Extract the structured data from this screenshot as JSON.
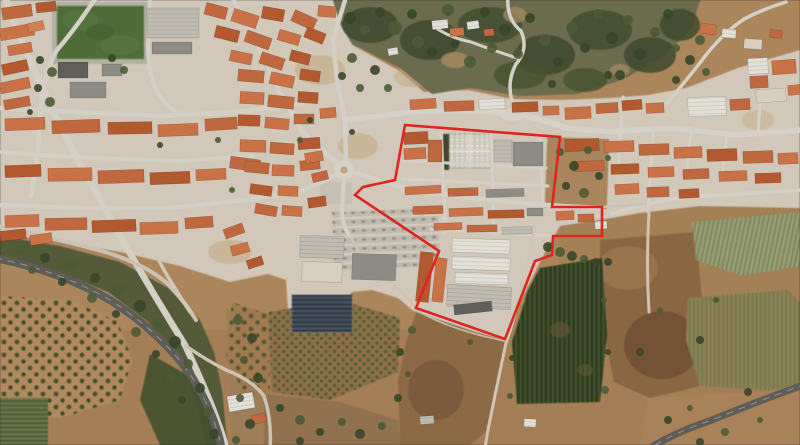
{
  "description": "Satellite aerial photograph of a town with terracotta rooftops, a wooded hillside, highways, farm fields and a red site-boundary polygon outlined over the central district.",
  "visible_text": [],
  "boundary": {
    "name": "red-boundary-polygon",
    "color": "#e02420",
    "stroke_width": 2.6,
    "points": "405,125 560,137 552,207 602,207 602,236 553,236 552,255 535,261 505,339 416,308 439,251 355,195 363,187 395,180"
  },
  "palette": {
    "terrain_base": "#ab865c",
    "town_ground": "#d1c8b9",
    "road": "#d5d0c6",
    "highway": "#5e5d57",
    "woodland": "#4d5836",
    "field_dirt": "#8a6743",
    "vineyard_dark": "#2e3b22",
    "sports_pitch": "#4e6c3a",
    "solar_panels": "#47525f",
    "boundary_red": "#e02420",
    "roof_palette": [
      "#bf6840",
      "#b2592f",
      "#ca7247",
      "#d48053",
      "#a64f2c",
      "#e3e0d8",
      "#c0bcb2",
      "#8e8b84",
      "#5f5e58",
      "#d8cfc0"
    ],
    "tree_greens": [
      "#39462a",
      "#4c5a36"
    ]
  },
  "features": [
    "town-with-terracotta-roofs",
    "red-boundary-polygon",
    "soccer-field",
    "cemetery",
    "warehouse-buildings",
    "solar-panel-array",
    "parking-lot",
    "wooded-hillside",
    "highway",
    "roundabout",
    "vineyard",
    "olive-grove",
    "orchard",
    "farm-fields"
  ]
}
